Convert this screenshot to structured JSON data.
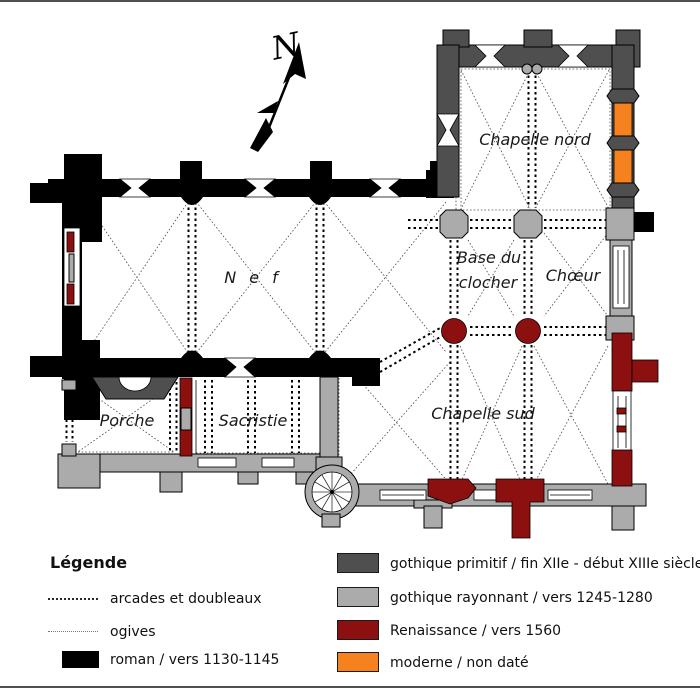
{
  "compass": {
    "label": "N"
  },
  "rooms": {
    "chapelle_nord": "Chapelle nord",
    "nef": "N e f",
    "base_du_clocher_line1": "Base du",
    "base_du_clocher_line2": "clocher",
    "choeur": "Chœur",
    "chapelle_sud": "Chapelle sud",
    "porche": "Porche",
    "sacristie": "Sacristie"
  },
  "legend": {
    "title": "Légende",
    "items_left": [
      {
        "label": "arcades et doubleaux",
        "swatch": "dashed-line"
      },
      {
        "label": "ogives",
        "swatch": "dotted-line"
      },
      {
        "label": "roman / vers 1130-1145",
        "swatch": "roman"
      }
    ],
    "items_right": [
      {
        "label": "gothique primitif / fin XIIe - début XIIIe siècle",
        "swatch": "gothique_primitif"
      },
      {
        "label": "gothique rayonnant / vers 1245-1280",
        "swatch": "gothique_rayonnant"
      },
      {
        "label": "Renaissance / vers 1560",
        "swatch": "renaissance"
      },
      {
        "label": "moderne / non daté",
        "swatch": "moderne"
      }
    ]
  },
  "colors": {
    "roman": "#000000",
    "gothique_primitif": "#4f4f4f",
    "gothique_rayonnant": "#ababab",
    "renaissance": "#8c1010",
    "moderne": "#f5821f"
  }
}
